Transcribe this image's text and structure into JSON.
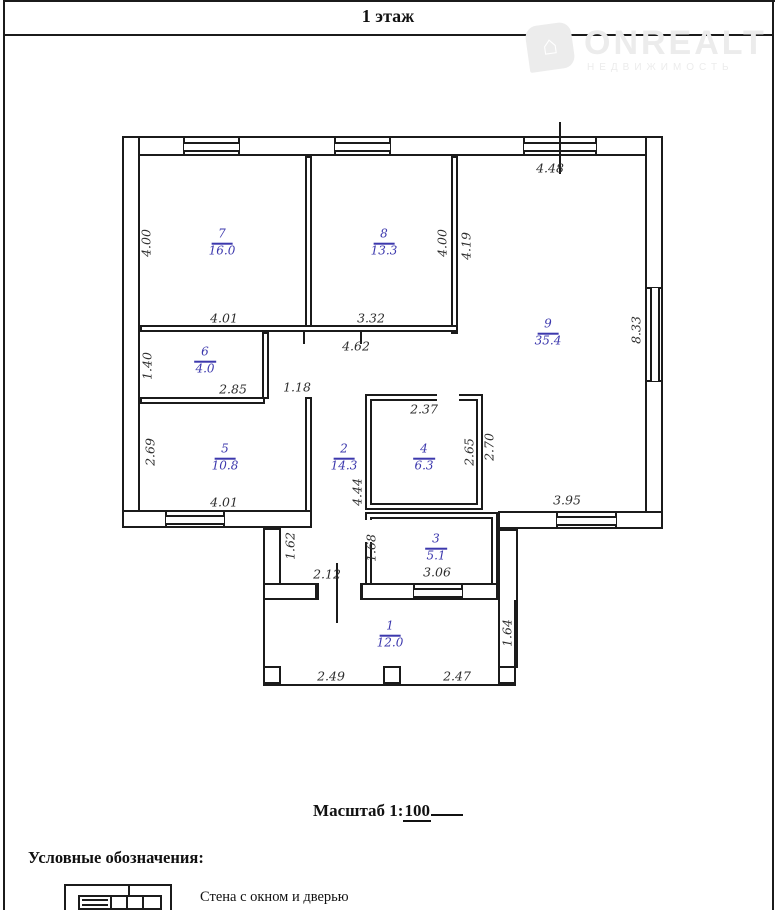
{
  "page": {
    "title": "1 этаж"
  },
  "watermark": {
    "brand": "ONREALT",
    "subtitle": "НЕДВИЖИМОСТЬ",
    "house_glyph": "⌂"
  },
  "plan": {
    "rooms": [
      {
        "number": "7",
        "area": "16.0",
        "x": 222,
        "y": 243
      },
      {
        "number": "8",
        "area": "13.3",
        "x": 384,
        "y": 243
      },
      {
        "number": "9",
        "area": "35.4",
        "x": 548,
        "y": 333
      },
      {
        "number": "6",
        "area": "4.0",
        "x": 205,
        "y": 361
      },
      {
        "number": "5",
        "area": "10.8",
        "x": 225,
        "y": 458
      },
      {
        "number": "2",
        "area": "14.3",
        "x": 344,
        "y": 458
      },
      {
        "number": "4",
        "area": "6.3",
        "x": 424,
        "y": 458
      },
      {
        "number": "3",
        "area": "5.1",
        "x": 436,
        "y": 548
      },
      {
        "number": "1",
        "area": "12.0",
        "x": 390,
        "y": 635
      }
    ],
    "dimensions": [
      {
        "text": "4.48",
        "x": 550,
        "y": 168,
        "vertical": false
      },
      {
        "text": "4.00",
        "x": 146,
        "y": 243,
        "vertical": true
      },
      {
        "text": "4.01",
        "x": 224,
        "y": 318,
        "vertical": false
      },
      {
        "text": "3.32",
        "x": 371,
        "y": 318,
        "vertical": false
      },
      {
        "text": "4.62",
        "x": 356,
        "y": 346,
        "vertical": false
      },
      {
        "text": "4.00",
        "x": 442,
        "y": 243,
        "vertical": true
      },
      {
        "text": "4.19",
        "x": 466,
        "y": 246,
        "vertical": true
      },
      {
        "text": "8.33",
        "x": 636,
        "y": 330,
        "vertical": true
      },
      {
        "text": "1.40",
        "x": 147,
        "y": 366,
        "vertical": true
      },
      {
        "text": "2.85",
        "x": 233,
        "y": 389,
        "vertical": false
      },
      {
        "text": "1.18",
        "x": 297,
        "y": 387,
        "vertical": false
      },
      {
        "text": "2.69",
        "x": 150,
        "y": 452,
        "vertical": true
      },
      {
        "text": "2.37",
        "x": 424,
        "y": 409,
        "vertical": false
      },
      {
        "text": "2.65",
        "x": 469,
        "y": 452,
        "vertical": true
      },
      {
        "text": "2.70",
        "x": 489,
        "y": 447,
        "vertical": true
      },
      {
        "text": "4.44",
        "x": 357,
        "y": 492,
        "vertical": true
      },
      {
        "text": "3.95",
        "x": 567,
        "y": 500,
        "vertical": false
      },
      {
        "text": "4.01",
        "x": 224,
        "y": 502,
        "vertical": false
      },
      {
        "text": "1.62",
        "x": 290,
        "y": 546,
        "vertical": true
      },
      {
        "text": "1.68",
        "x": 371,
        "y": 548,
        "vertical": true
      },
      {
        "text": "2.12",
        "x": 327,
        "y": 574,
        "vertical": false
      },
      {
        "text": "3.06",
        "x": 437,
        "y": 572,
        "vertical": false
      },
      {
        "text": "1.64",
        "x": 507,
        "y": 633,
        "vertical": true
      },
      {
        "text": "2.49",
        "x": 331,
        "y": 676,
        "vertical": false
      },
      {
        "text": "2.47",
        "x": 457,
        "y": 676,
        "vertical": false
      }
    ]
  },
  "scale": {
    "prefix": "Масштаб 1:",
    "value": "100"
  },
  "legend": {
    "heading": "Условные обозначения:",
    "item_label": "Стена с окном и дверью"
  },
  "colors": {
    "line": "#1b1b1b",
    "room_label": "#3c38ad",
    "dim_text": "#2e2e2e",
    "watermark": "#ececec"
  }
}
